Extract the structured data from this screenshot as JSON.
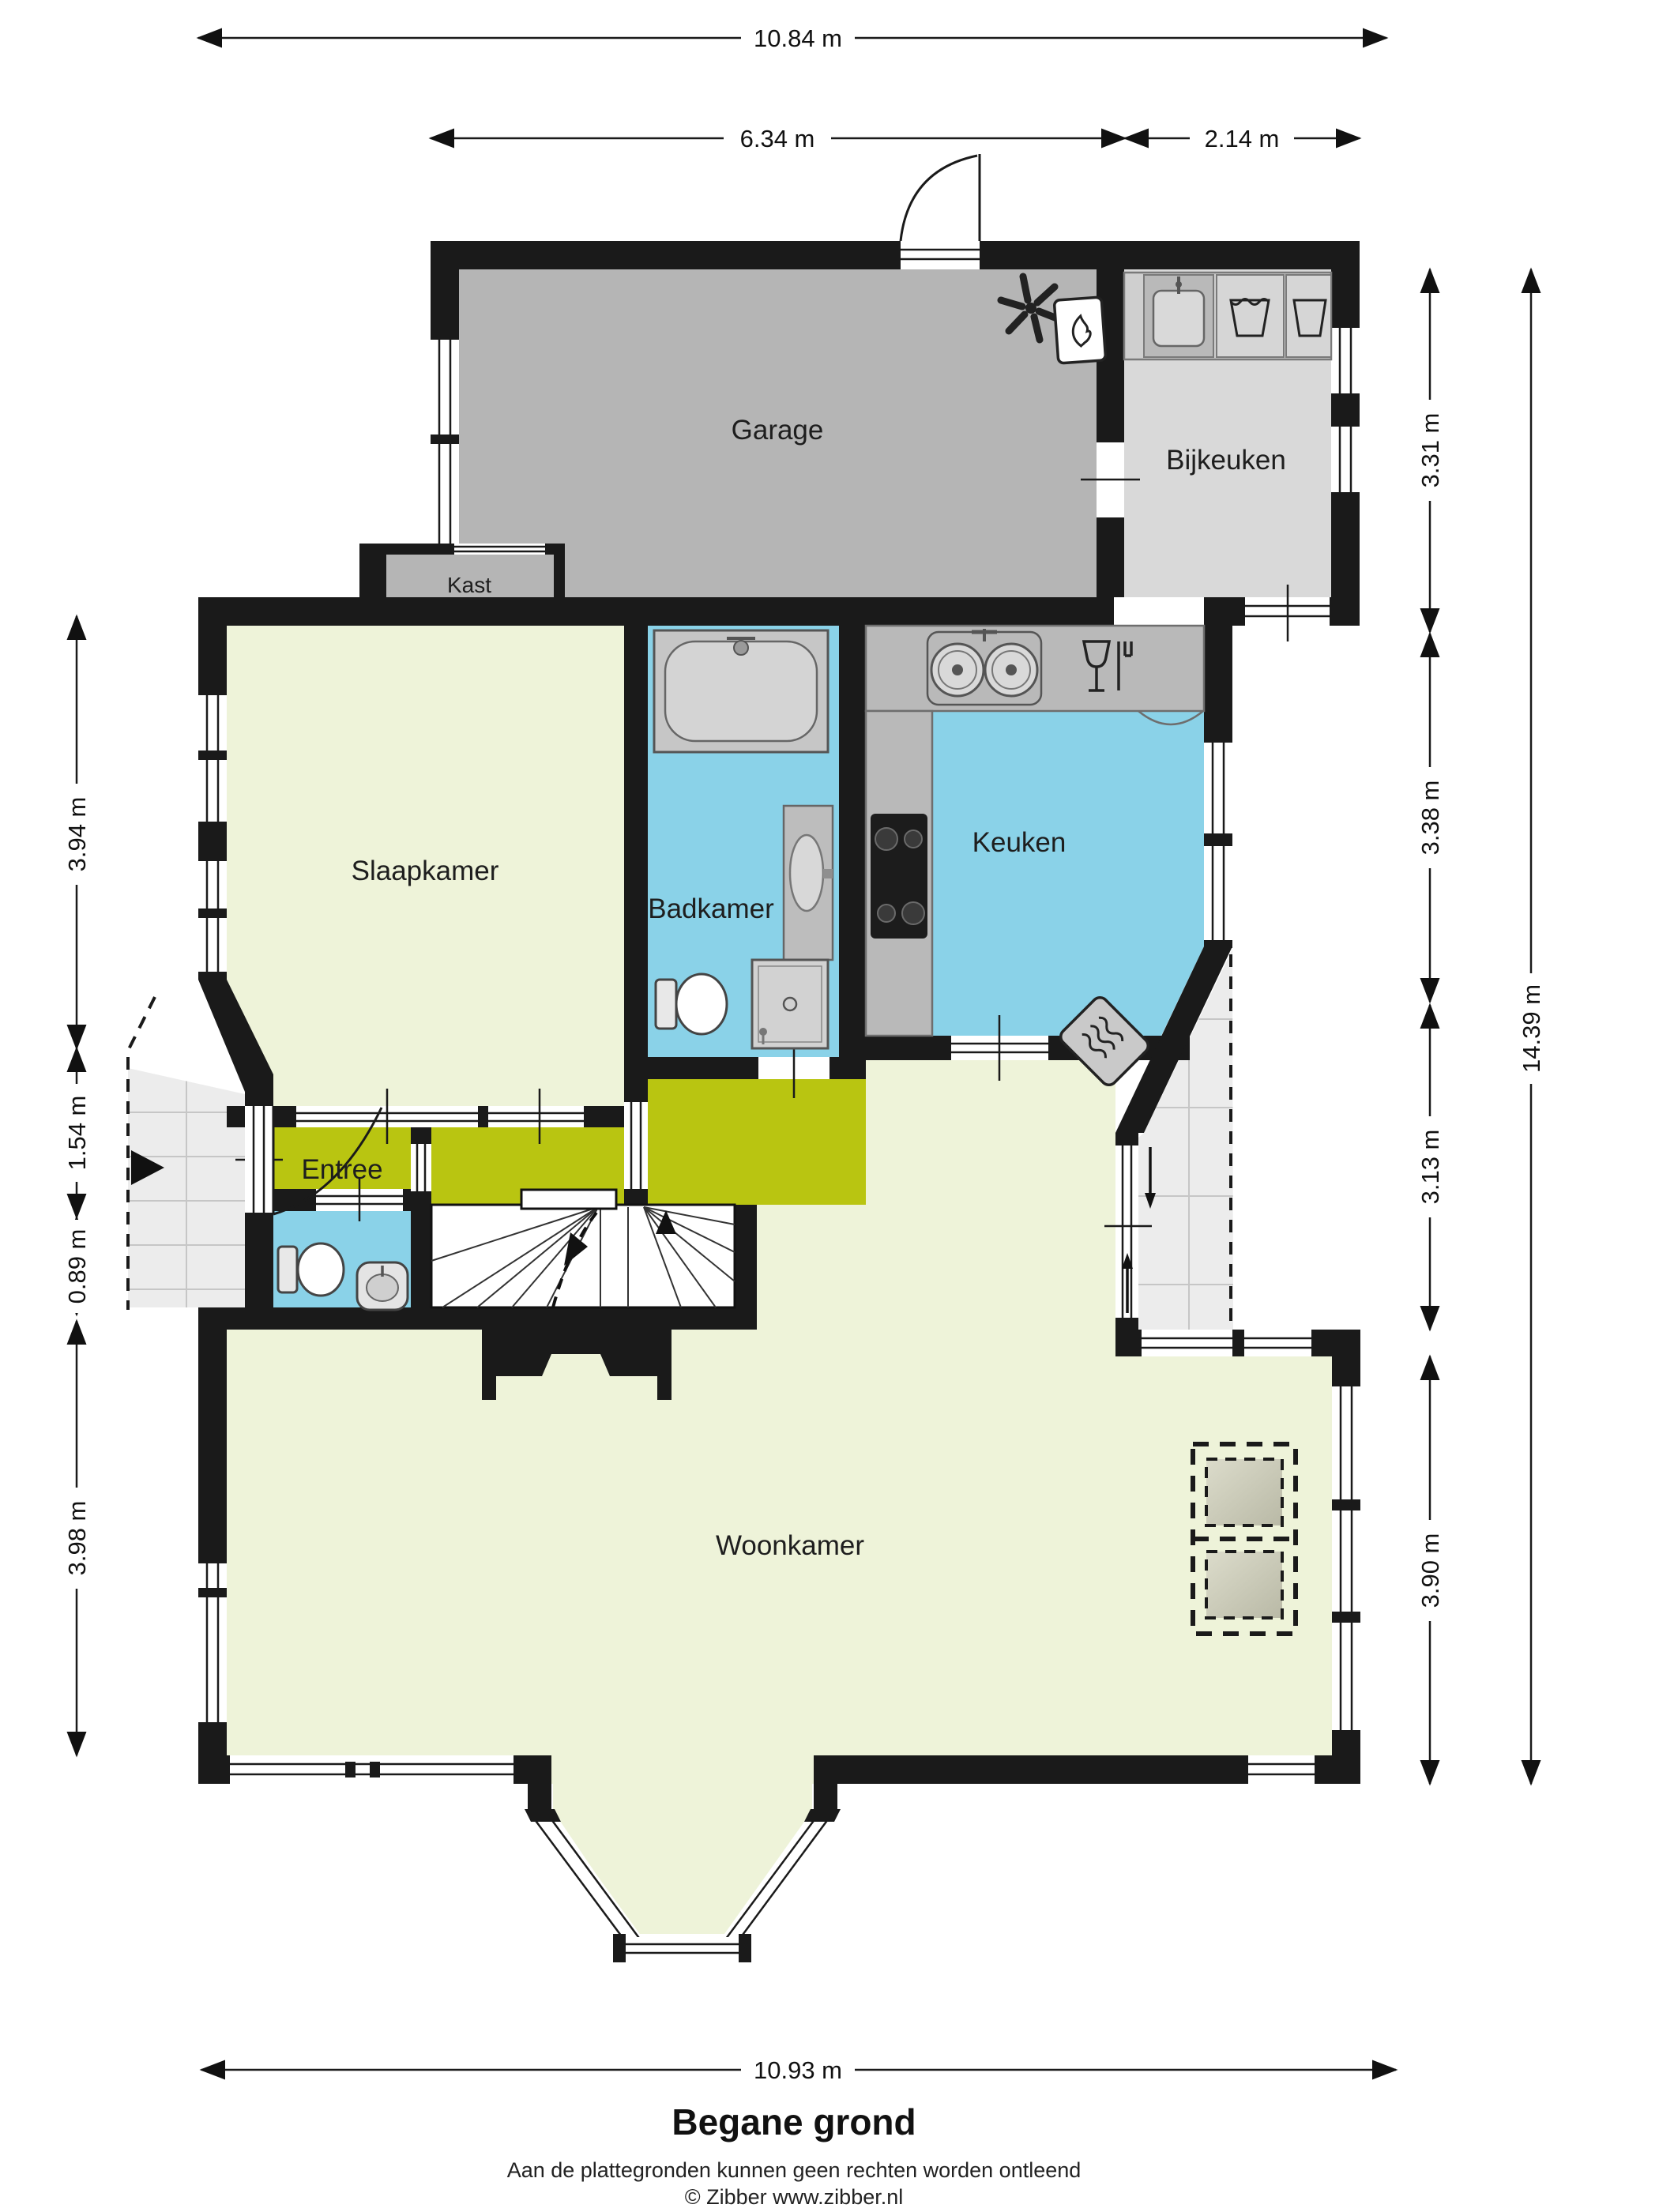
{
  "meta": {
    "title": "Begane grond",
    "disclaimer": "Aan de plattegronden kunnen geen rechten worden ontleend",
    "copyright": "© Zibber www.zibber.nl"
  },
  "rooms": {
    "garage": "Garage",
    "bijkeuken": "Bijkeuken",
    "kast": "Kast",
    "slaapkamer": "Slaapkamer",
    "badkamer": "Badkamer",
    "keuken": "Keuken",
    "entree": "Entree",
    "woonkamer": "Woonkamer"
  },
  "dimensions": {
    "total_width": "10.84 m",
    "garage_width": "6.34 m",
    "bijkeuken_width": "2.14 m",
    "left_slaapkamer": "3.94 m",
    "left_entree": "1.54 m",
    "left_porch": "0.89 m",
    "left_woonkamer": "3.98 m",
    "right_bijkeuken": "3.31 m",
    "right_keuken": "3.38 m",
    "right_terras": "3.13 m",
    "right_woonkamer": "3.90 m",
    "right_total": "14.39 m",
    "bottom_width": "10.93 m"
  },
  "colors": {
    "wall": "#1a1a1a",
    "living_floor": "#eef3d9",
    "wet_floor": "#8ad2e8",
    "hall_floor": "#b9c511",
    "garage_floor": "#b5b5b5",
    "utility_floor": "#d9d9d9",
    "counter": "#b9b9b9",
    "tile": "#ececec"
  },
  "icons": {
    "ceiling-fan-icon": "ventilation fan",
    "boiler-icon": "central heating boiler",
    "utility-sink-icon": "utility sink",
    "washing-machine-icon": "washing machine",
    "kitchen-sink-icon": "double kitchen sink",
    "dishwasher-icon": "glass and fork symbol",
    "cooktop-icon": "4-burner cooktop",
    "bathtub-icon": "bathtub",
    "washbasin-icon": "washbasin cabinet",
    "shower-icon": "shower tray",
    "toilet-icon": "toilet",
    "hand-basin-icon": "hand basin",
    "radiator-icon": "radiator",
    "stairs-icon": "winder staircase",
    "front-door-icon": "entrance door swing",
    "garage-door-icon": "garage side door swing",
    "entry-arrow-icon": "entry direction arrow",
    "sliding-door-arrows": "sliding door direction",
    "skylight-icon": "dashed ceiling element"
  }
}
